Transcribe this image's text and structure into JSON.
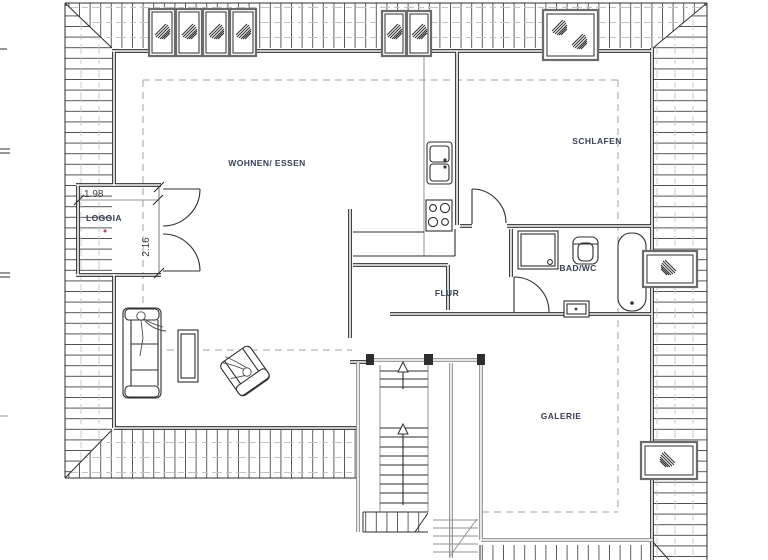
{
  "drawing": {
    "type": "architectural-floor-plan",
    "floor": "attic storey with surrounding roof area"
  },
  "colors": {
    "background": "#ffffff",
    "wall": "#2e2e2e",
    "light_wall": "#909090",
    "hatch_dark": "#4e4e4e",
    "hatch_light": "#c3c3c3",
    "dashed": "#a2a2a2",
    "label": "#3a3f55",
    "dimension": "#3f3f3f",
    "accent_dot": "#b5446e"
  },
  "rooms": {
    "living": {
      "label": "WOHNEN/ ESSEN"
    },
    "sleeping": {
      "label": "SCHLAFEN"
    },
    "loggia": {
      "label": "LOGGIA"
    },
    "bath": {
      "label": "BAD/WC"
    },
    "hall": {
      "label": "FLUR"
    },
    "gallery": {
      "label": "GALERIE"
    }
  },
  "dimensions": {
    "loggia_width": "1.98",
    "loggia_depth": "2.16"
  },
  "icons": {
    "roof_window_glyph": "diagonal-hatch-leaf",
    "stair_direction_arrow": "up-arrow"
  }
}
